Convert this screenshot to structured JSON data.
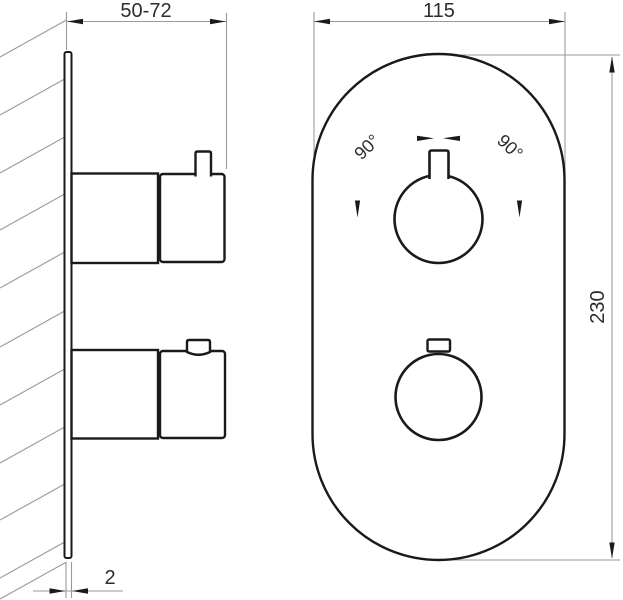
{
  "drawing": {
    "type": "technical-installation-drawing",
    "views": {
      "side_view": "wall-mounted mixer, section through wall",
      "front_view": "oval cover plate with two round handles"
    }
  },
  "dimensions": {
    "wall_depth": "50-72",
    "plate_thickness": "2",
    "plate_width": "115",
    "plate_height": "230"
  },
  "angles": {
    "left": "90°",
    "right": "90°"
  },
  "colors": {
    "object_line": "#1a1a1a",
    "thin_line": "#9a9a9a",
    "label_text": "#2d2d2d",
    "background": "#ffffff"
  }
}
